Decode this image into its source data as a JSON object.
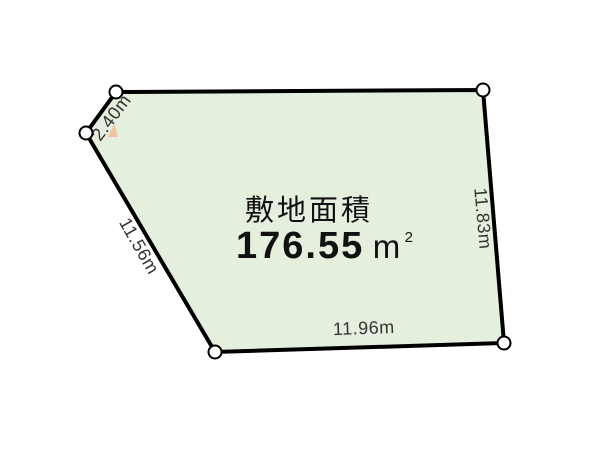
{
  "diagram": {
    "area_label": "敷地面積",
    "area_value": "176.55",
    "area_unit": "m",
    "area_exponent": "2",
    "dimensions": {
      "top_left_edge": "2.40m",
      "left_edge": "11.56m",
      "right_edge": "11.83m",
      "bottom_edge": "11.96m"
    },
    "colors": {
      "parcel_fill": "#e4efde",
      "outline": "#000000",
      "dimension_text": "#333333",
      "area_text": "#111111",
      "vertex_fill": "#ffffff",
      "triangle_marker": "#f2c3a0"
    }
  }
}
